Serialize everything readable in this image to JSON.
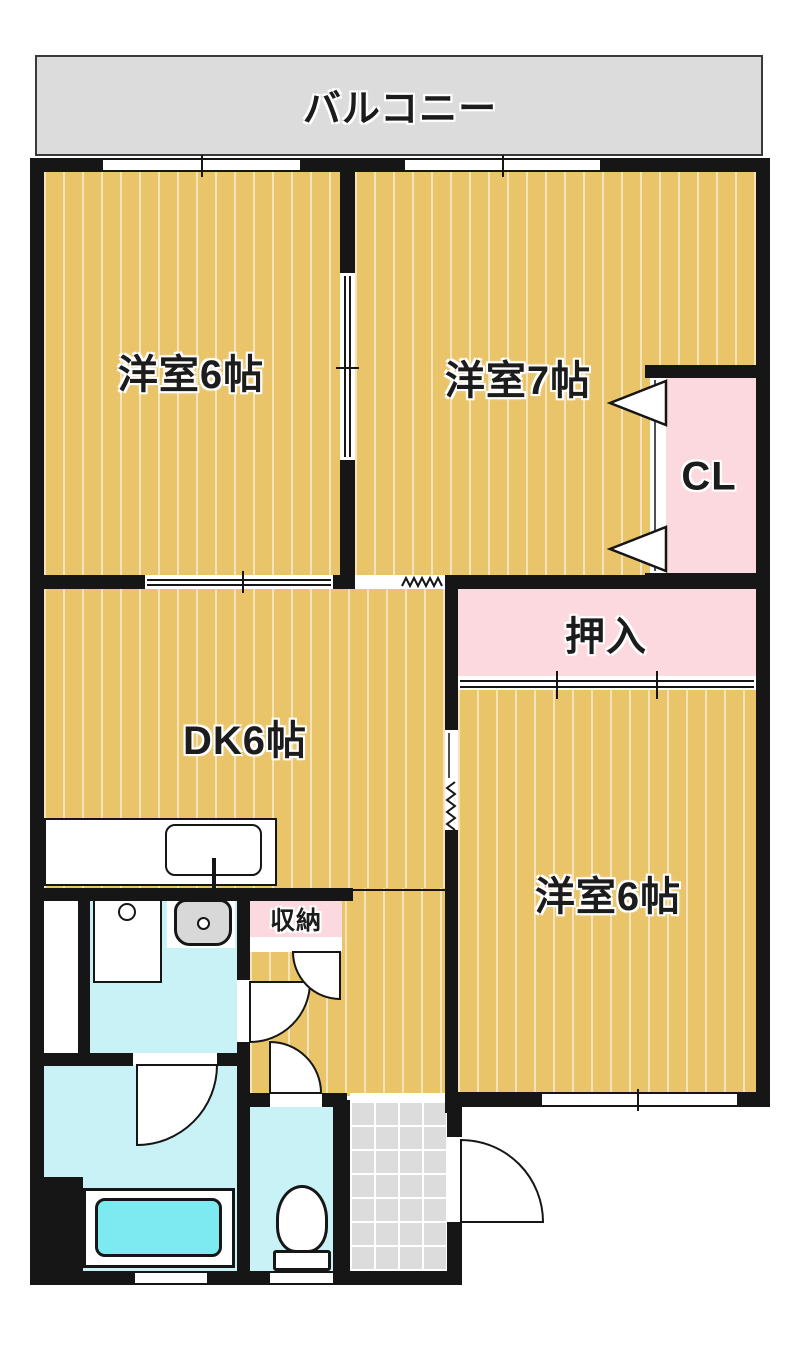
{
  "balcony": {
    "label": "バルコニー"
  },
  "rooms": {
    "bedroom_top_left": {
      "label": "洋室6帖"
    },
    "bedroom_top_right": {
      "label": "洋室7帖"
    },
    "closet": {
      "label": "CL"
    },
    "oshiire": {
      "label": "押入"
    },
    "dining_kitchen": {
      "label": "DK6帖"
    },
    "bedroom_bottom_right": {
      "label": "洋室6帖"
    },
    "storage": {
      "label": "収納"
    }
  },
  "colors": {
    "wall": "#161616",
    "wood": "#e9c469",
    "pink": "#fbd9de",
    "cyan": "#c9f2f6",
    "tub": "#7de9f0",
    "gray": "#dcdcdc"
  }
}
